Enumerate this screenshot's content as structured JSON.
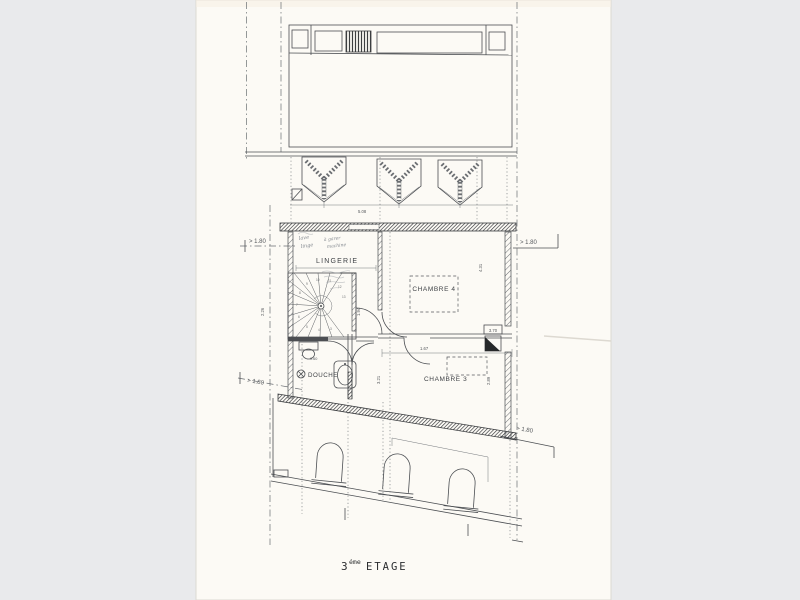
{
  "page": {
    "background_color": "#e9eaec",
    "paper_color": "#fcfaf5",
    "ink_color": "#4b4e52"
  },
  "title": {
    "floor_number": "3",
    "superscript": "éme",
    "word": "ETAGE"
  },
  "rooms": {
    "lingerie": "LINGERIE",
    "chambre4": "CHAMBRE 4",
    "chambre3": "CHAMBRE 3",
    "douche": "DOUCHE"
  },
  "clearance": {
    "top_left": "> 1.80",
    "top_right": "> 1.80",
    "bottom_left": "> 1.80",
    "bottom_right": "> 1.80"
  },
  "dimensions": {
    "lingerie_width": "5.08",
    "left_height": "2.26",
    "stair_depth": "1.94",
    "chambre4_height": "4.31",
    "chambre3_depth": "3.21",
    "chambre3_right_height": "2.89",
    "chambre3_width": "1.67",
    "douche_fixture": "0.60",
    "duct_label": "3.70"
  },
  "handwritten": {
    "word1": "lave",
    "word2": "linge",
    "word3": "à garer",
    "word4": "machine"
  },
  "stairs": {
    "steps": [
      "3",
      "4",
      "5",
      "6",
      "7",
      "8",
      "9",
      "10",
      "11",
      "12",
      "13"
    ]
  }
}
